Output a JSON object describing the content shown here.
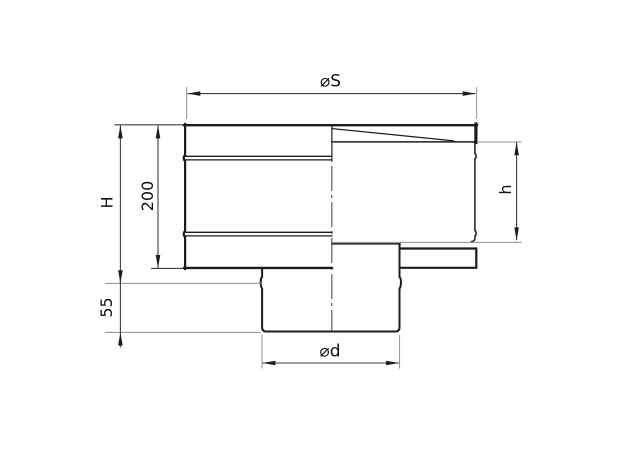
{
  "drawing": {
    "type": "technical-dimension-drawing",
    "labels": {
      "outer_diameter": "⌀S",
      "total_height": "H",
      "body_height": "200",
      "cone_height": "h",
      "outlet_height": "55",
      "outlet_diameter": "⌀d"
    },
    "colors": {
      "background": "#ffffff",
      "outline": "#1c1c1c",
      "dimension_line": "#3d3d3d",
      "extension_line": "#9a9a9a",
      "text": "#111111"
    }
  }
}
